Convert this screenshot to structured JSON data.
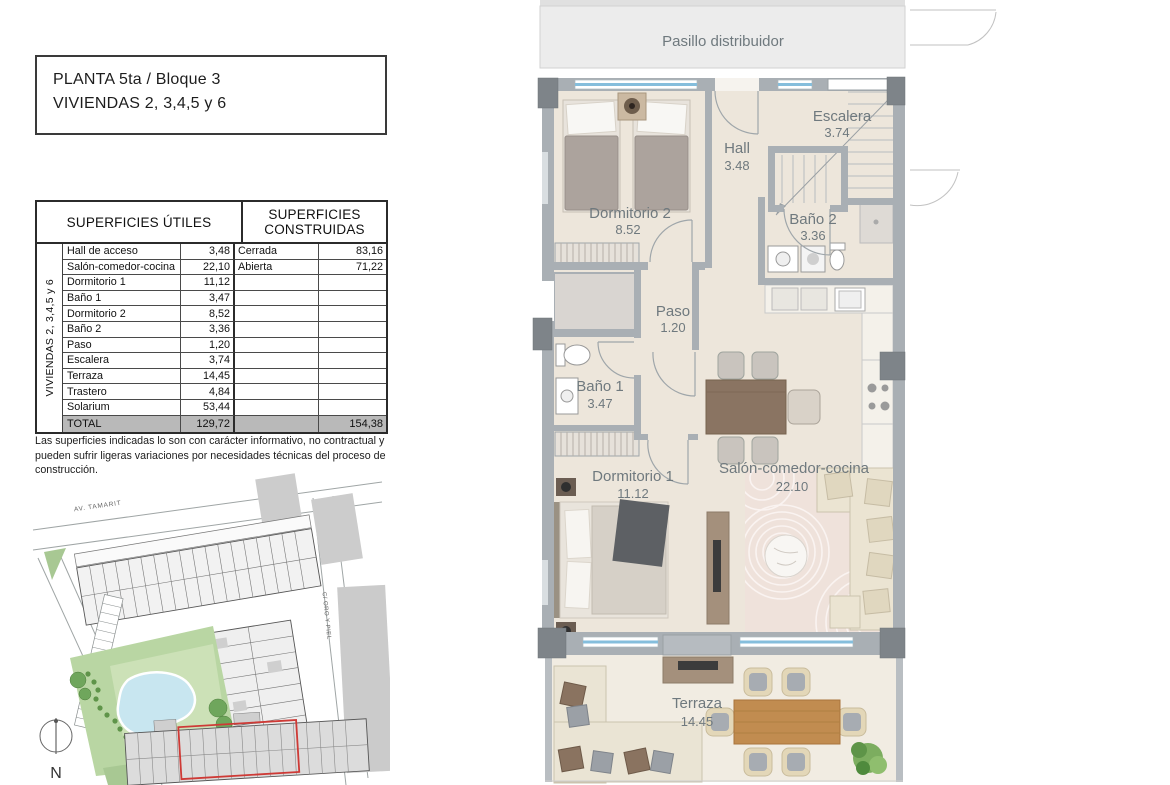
{
  "title": {
    "line1": "PLANTA 5ta / Bloque 3",
    "line2": "VIVIENDAS 2, 3,4,5 y 6"
  },
  "table": {
    "header_utiles": "SUPERFICIES ÚTILES",
    "header_construidas_1": "SUPERFICIES",
    "header_construidas_2": "CONSTRUIDAS",
    "side_label": "VIVIENDAS 2, 3,4,5 y 6",
    "rows": [
      {
        "name": "Hall de acceso",
        "value": "3,48",
        "cname": "Cerrada",
        "cvalue": "83,16"
      },
      {
        "name": "Salón-comedor-cocina",
        "value": "22,10",
        "cname": "Abierta",
        "cvalue": "71,22"
      },
      {
        "name": "Dormitorio 1",
        "value": "11,12",
        "cname": "",
        "cvalue": ""
      },
      {
        "name": "Baño 1",
        "value": "3,47",
        "cname": "",
        "cvalue": ""
      },
      {
        "name": "Dormitorio 2",
        "value": "8,52",
        "cname": "",
        "cvalue": ""
      },
      {
        "name": "Baño 2",
        "value": "3,36",
        "cname": "",
        "cvalue": ""
      },
      {
        "name": "Paso",
        "value": "1,20",
        "cname": "",
        "cvalue": ""
      },
      {
        "name": "Escalera",
        "value": "3,74",
        "cname": "",
        "cvalue": ""
      },
      {
        "name": "Terraza",
        "value": "14,45",
        "cname": "",
        "cvalue": ""
      },
      {
        "name": "Trastero",
        "value": "4,84",
        "cname": "",
        "cvalue": ""
      },
      {
        "name": "Solarium",
        "value": "53,44",
        "cname": "",
        "cvalue": ""
      }
    ],
    "total": {
      "name": "TOTAL",
      "value": "129,72",
      "cname": "",
      "cvalue": "154,38"
    }
  },
  "note": "Las superficies indicadas lo son con carácter informativo, no contractual y pueden sufrir ligeras variaciones por necesidades técnicas del proceso de construcción.",
  "site_plan": {
    "street_1": "AV. TAMARIT",
    "street_2": "C/ ORO Y PIEL",
    "north_label": "N"
  },
  "floor_plan": {
    "pasillo": {
      "name": "Pasillo distribuidor"
    },
    "dormitorio2": {
      "name": "Dormitorio 2",
      "area": "8.52"
    },
    "hall": {
      "name": "Hall",
      "area": "3.48"
    },
    "escalera": {
      "name": "Escalera",
      "area": "3.74"
    },
    "bano2": {
      "name": "Baño 2",
      "area": "3.36"
    },
    "paso": {
      "name": "Paso",
      "area": "1.20"
    },
    "bano1": {
      "name": "Baño 1",
      "area": "3.47"
    },
    "dormitorio1": {
      "name": "Dormitorio 1",
      "area": "11.12"
    },
    "salon": {
      "name": "Salón-comedor-cocina",
      "area": "22.10"
    },
    "terraza": {
      "name": "Terraza",
      "area": "14.45"
    }
  },
  "colors": {
    "floor_beige": "#EDE6DB",
    "terrace_beige": "#F1ECE2",
    "wall_grey": "#A9AFB4",
    "pillar_grey": "#7E8489",
    "window_blue": "#85BEDC",
    "label_text": "#6F797E",
    "pasillo_grey": "#ECECEC",
    "total_row_grey": "#B9B9B9",
    "highlight_red": "#CE3A36",
    "park_green": "#B9D6A3",
    "pool_blue": "#C8E6F0",
    "table_wood": "#8A7462",
    "terrace_wood": "#C18C50"
  }
}
